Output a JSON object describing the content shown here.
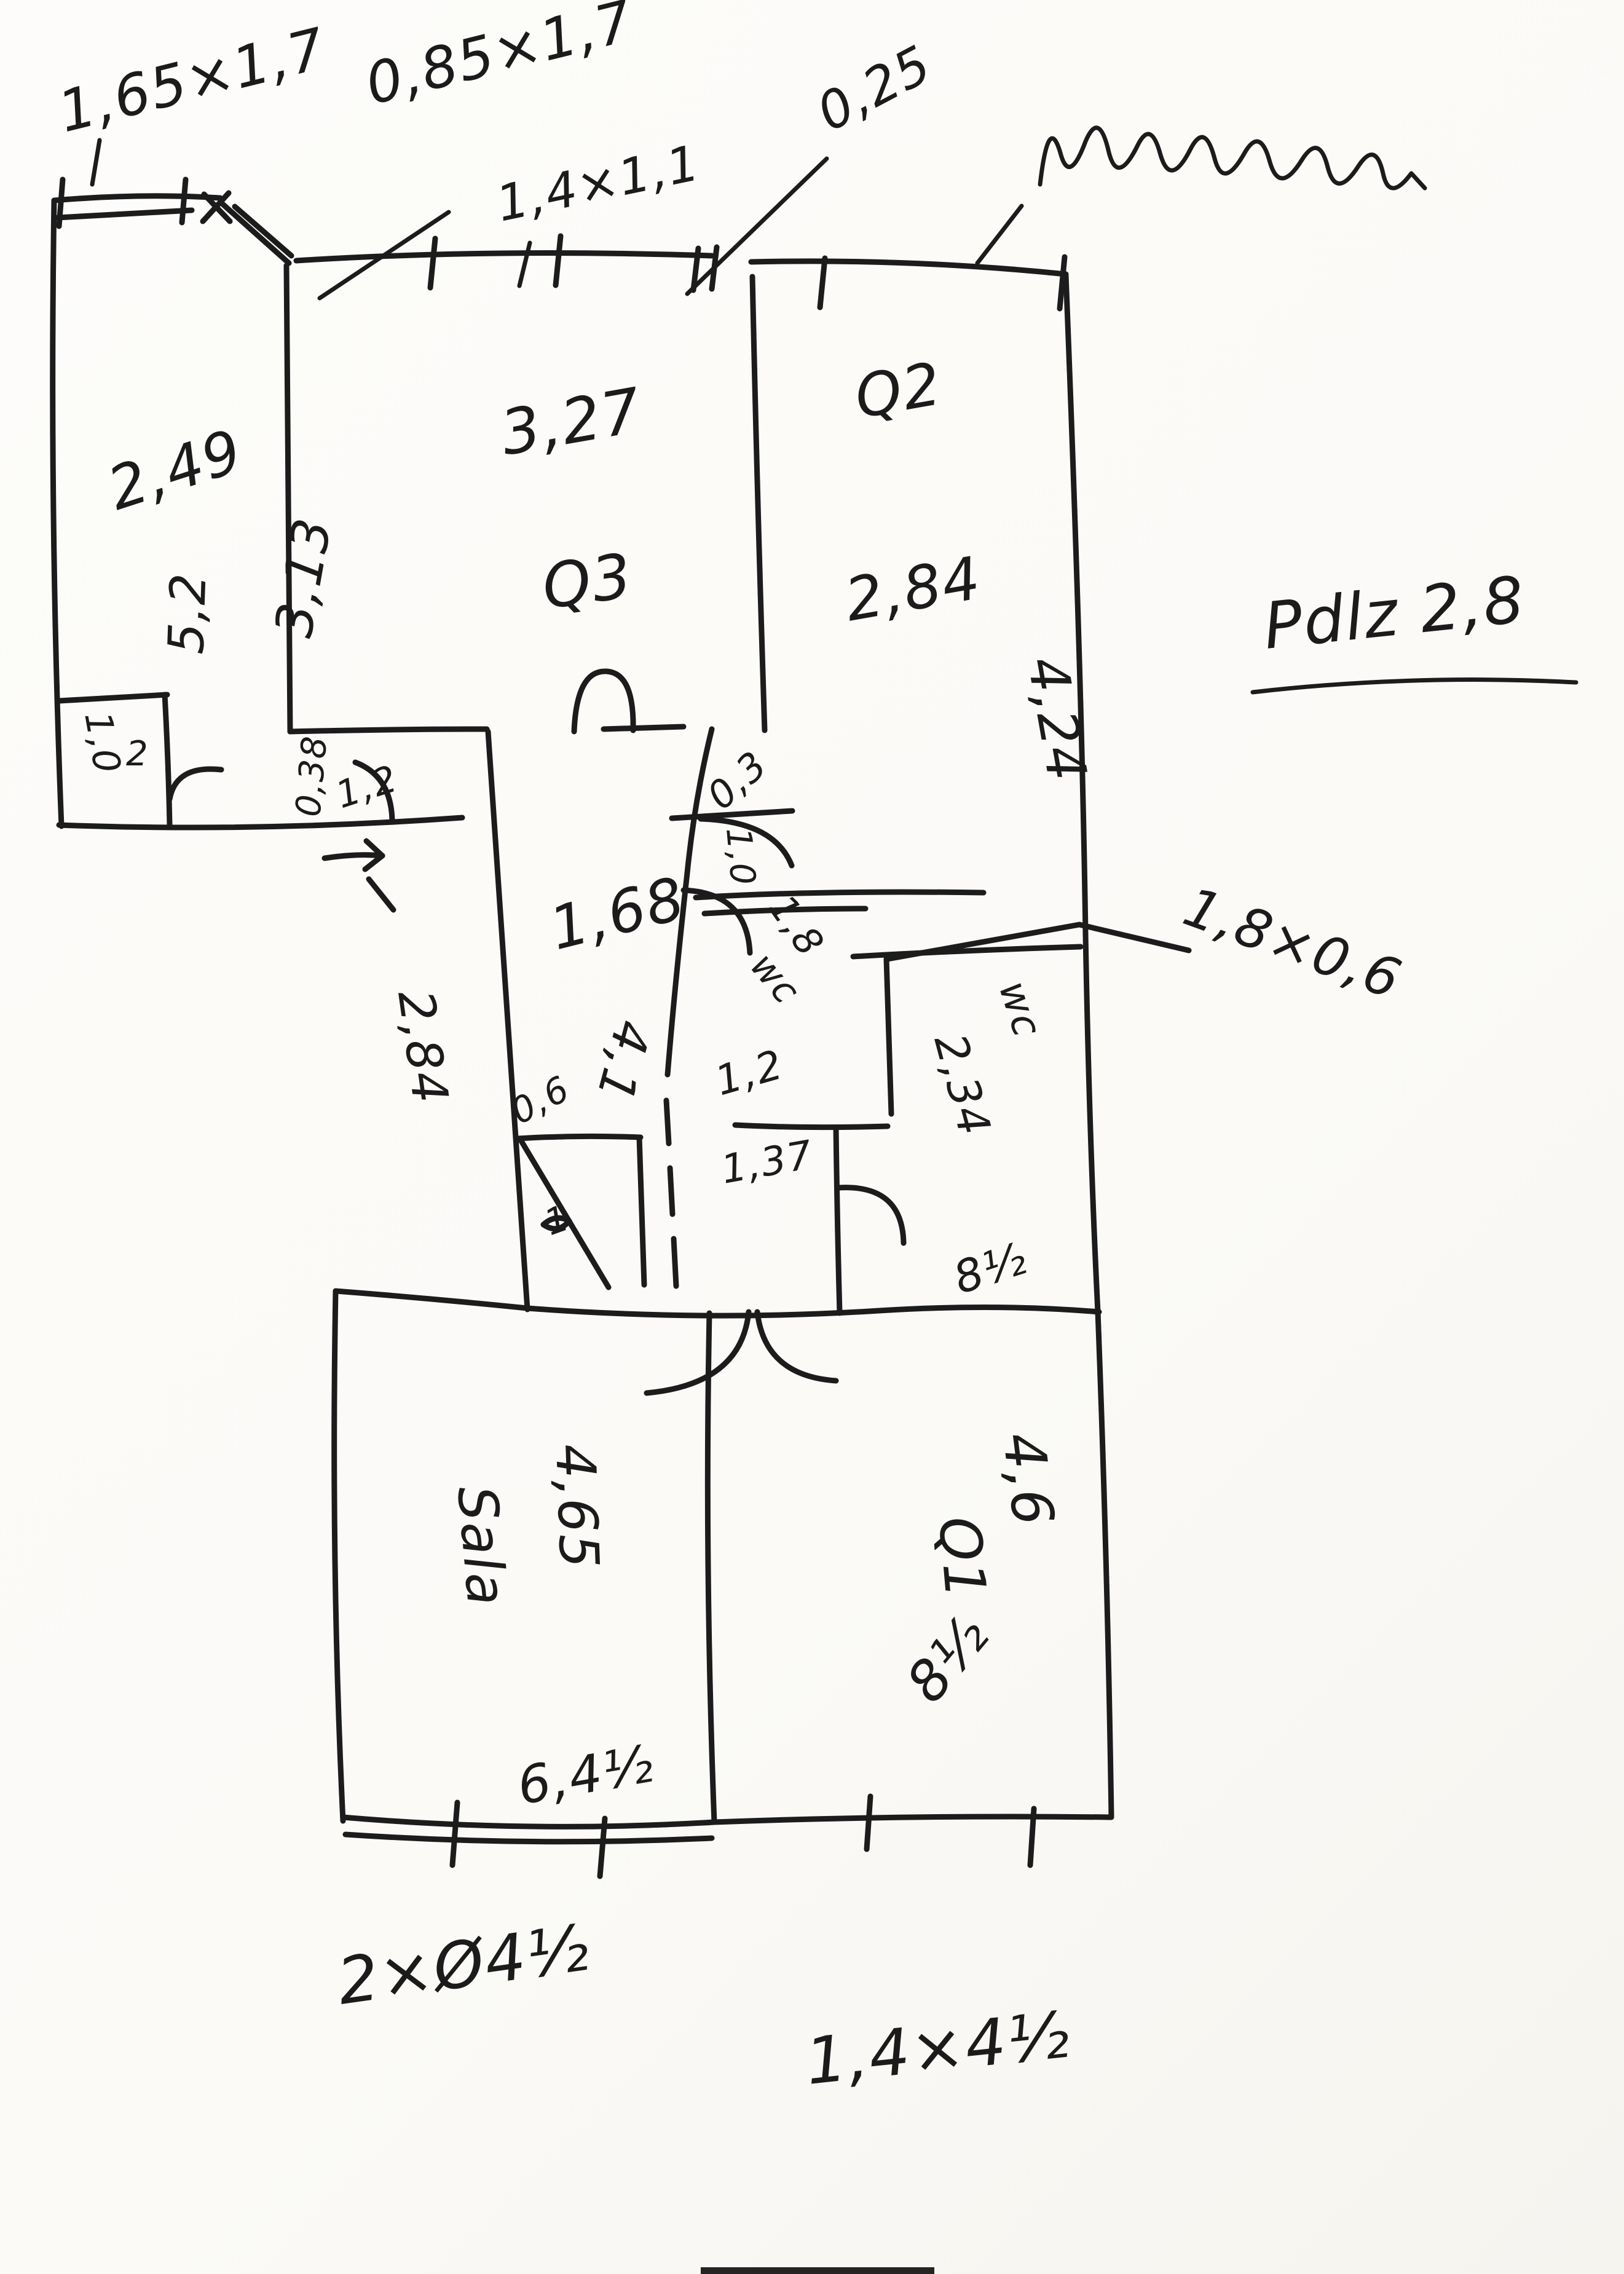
{
  "paper": {
    "background": "#fbfaf7",
    "ink": "#1c1c1c",
    "kind": "hand-drawn floor plan sketch"
  },
  "labels": {
    "win_left": {
      "text": "1,65×1,7"
    },
    "door_entry_top": {
      "text": "0,85×1,7"
    },
    "win_mid": {
      "text": "1,4×1,1"
    },
    "wall_025": {
      "text": "0,25"
    },
    "room1_w": {
      "text": "2,49"
    },
    "room1_h": {
      "text": "5,2"
    },
    "room2_l": {
      "text": "3,13"
    },
    "closet_w": {
      "text": "1,0"
    },
    "closet_n": {
      "text": "2"
    },
    "room2_w": {
      "text": "3,27"
    },
    "room2_name": {
      "text": "Q3"
    },
    "room3_name": {
      "text": "Q2"
    },
    "room3_w": {
      "text": "2,84"
    },
    "room3_h": {
      "text": "4,24"
    },
    "note_height": {
      "text": "Pdlz 2,8"
    },
    "dim_038": {
      "text": "0,38"
    },
    "entry_w": {
      "text": "1,2"
    },
    "dim_03": {
      "text": "0,3"
    },
    "hall_door": {
      "text": "1,0"
    },
    "hall_w": {
      "text": "1,68"
    },
    "hall_l": {
      "text": "4,1"
    },
    "hall_l2": {
      "text": "2,84"
    },
    "wc1_dim": {
      "text": "1,8"
    },
    "wc1_name": {
      "text": "wc"
    },
    "wc1_w": {
      "text": "1,2"
    },
    "wc1_l": {
      "text": "1,37"
    },
    "wc2_name": {
      "text": "wc"
    },
    "wc2_l": {
      "text": "2,34"
    },
    "wc_win": {
      "text": "1,8×0,6"
    },
    "shaft_w": {
      "text": "0,6"
    },
    "shaft_mark": {
      "text": "1"
    },
    "wc_area": {
      "text": "8½"
    },
    "sala_name": {
      "text": "Sala"
    },
    "sala_l": {
      "text": "4,65"
    },
    "sala_w": {
      "text": "6,4½"
    },
    "q1_name": {
      "text": "Q1"
    },
    "q1_l": {
      "text": "4,6"
    },
    "q1_area": {
      "text": "8½"
    },
    "note_bottom_left": {
      "text": "2×Ø4½"
    },
    "note_bottom_right": {
      "text": "1,4×4½"
    }
  }
}
